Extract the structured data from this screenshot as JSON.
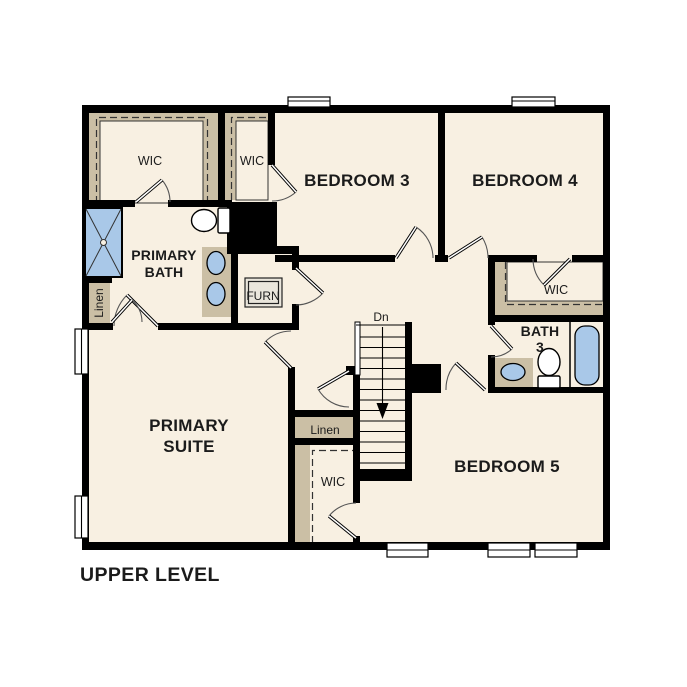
{
  "title": "UPPER LEVEL",
  "rooms": {
    "primary_suite": {
      "line1": "PRIMARY",
      "line2": "SUITE"
    },
    "primary_bath": {
      "line1": "PRIMARY",
      "line2": "BATH"
    },
    "bedroom3": {
      "label": "BEDROOM 3"
    },
    "bedroom4": {
      "label": "BEDROOM 4"
    },
    "bedroom5": {
      "label": "BEDROOM 5"
    },
    "bath3": {
      "line1": "BATH",
      "line2": "3"
    },
    "wic_primary": {
      "label": "WIC"
    },
    "wic_hall": {
      "label": "WIC"
    },
    "wic_bedroom4": {
      "label": "WIC"
    },
    "wic_bedroom5": {
      "label": "WIC"
    },
    "linen_bath": {
      "label": "Linen"
    },
    "linen_hall": {
      "label": "Linen"
    },
    "furnace": {
      "label": "FURN"
    },
    "stairs": {
      "label": "Dn"
    }
  },
  "colors": {
    "wall": "#000000",
    "floor": "#f8f0e2",
    "closet_tan": "#cbbfa5",
    "fixture_blue": "#a9c8e8",
    "background": "#ffffff"
  }
}
